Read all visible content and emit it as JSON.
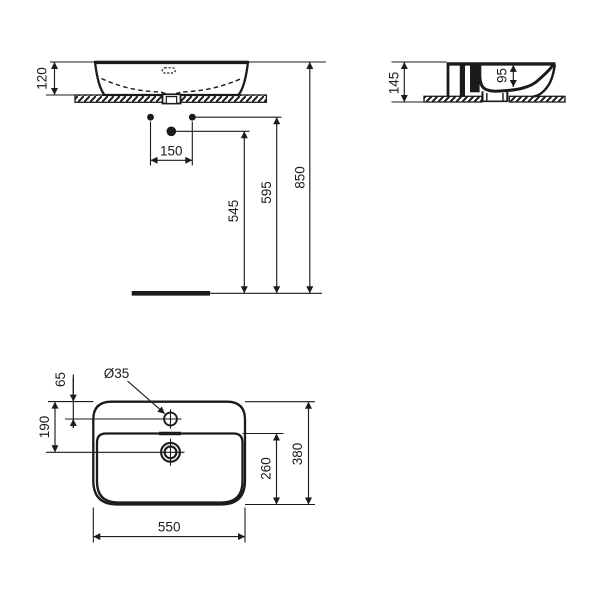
{
  "drawing": {
    "type": "washbasin-dimension-drawing",
    "style": {
      "line_color": "#1b1b1b",
      "background": "#ffffff"
    }
  },
  "dims": {
    "front": {
      "basin_height": "120",
      "hole_spacing": "150",
      "outlet_height": "545",
      "holes_height": "595",
      "rim_height": "850"
    },
    "side": {
      "overall_height": "145",
      "bowl_depth": "95"
    },
    "top": {
      "tap_hole_diameter": "Ø35",
      "tap_hole_offset": "65",
      "drain_offset": "190",
      "bowl_length": "260",
      "overall_depth": "380",
      "overall_width": "550"
    }
  }
}
